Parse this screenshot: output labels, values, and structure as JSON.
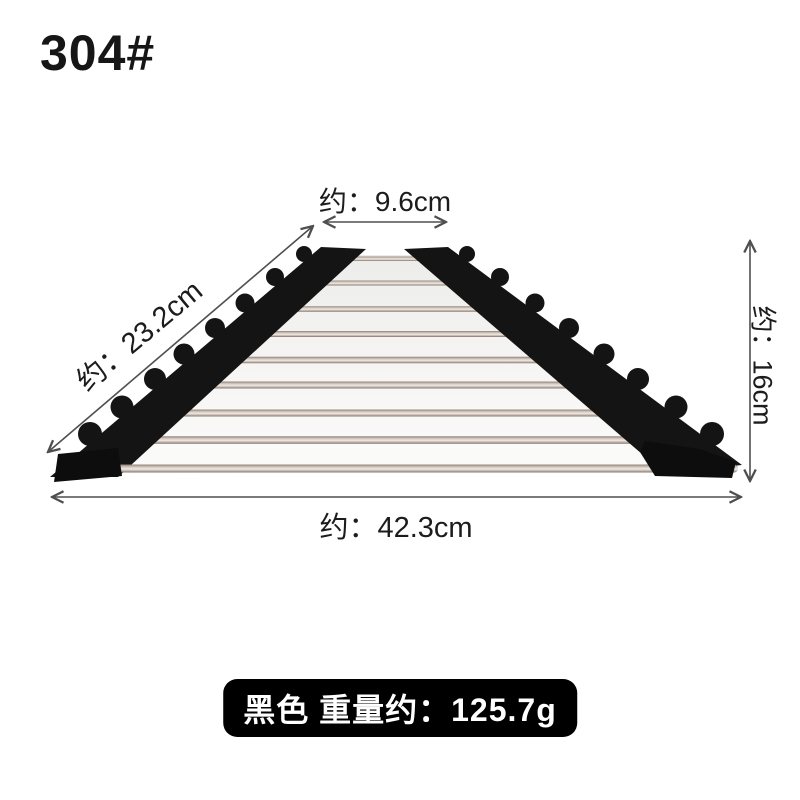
{
  "model_label": "304#",
  "dimensions": {
    "top_width": {
      "label": "约：9.6cm"
    },
    "slant_depth": {
      "label": "约：23.2cm"
    },
    "height": {
      "label": "约：16cm"
    },
    "bottom_width": {
      "label": "约：42.3cm"
    }
  },
  "weight_badge": {
    "label": "黑色 重量约：125.7g"
  },
  "product": {
    "type_shown": "roll-up triangular rack of steel rods with black silicone edges",
    "rod_count": 9
  },
  "colors": {
    "background": "#ffffff",
    "annotation_line": "#4f4f4f",
    "annotation_text": "#1c1c1c",
    "badge_background": "#000000",
    "badge_text": "#ffffff",
    "silicone_black": "#141414",
    "rod_highlight": "#efe9e4",
    "rod_shadow": "#8e8077"
  }
}
